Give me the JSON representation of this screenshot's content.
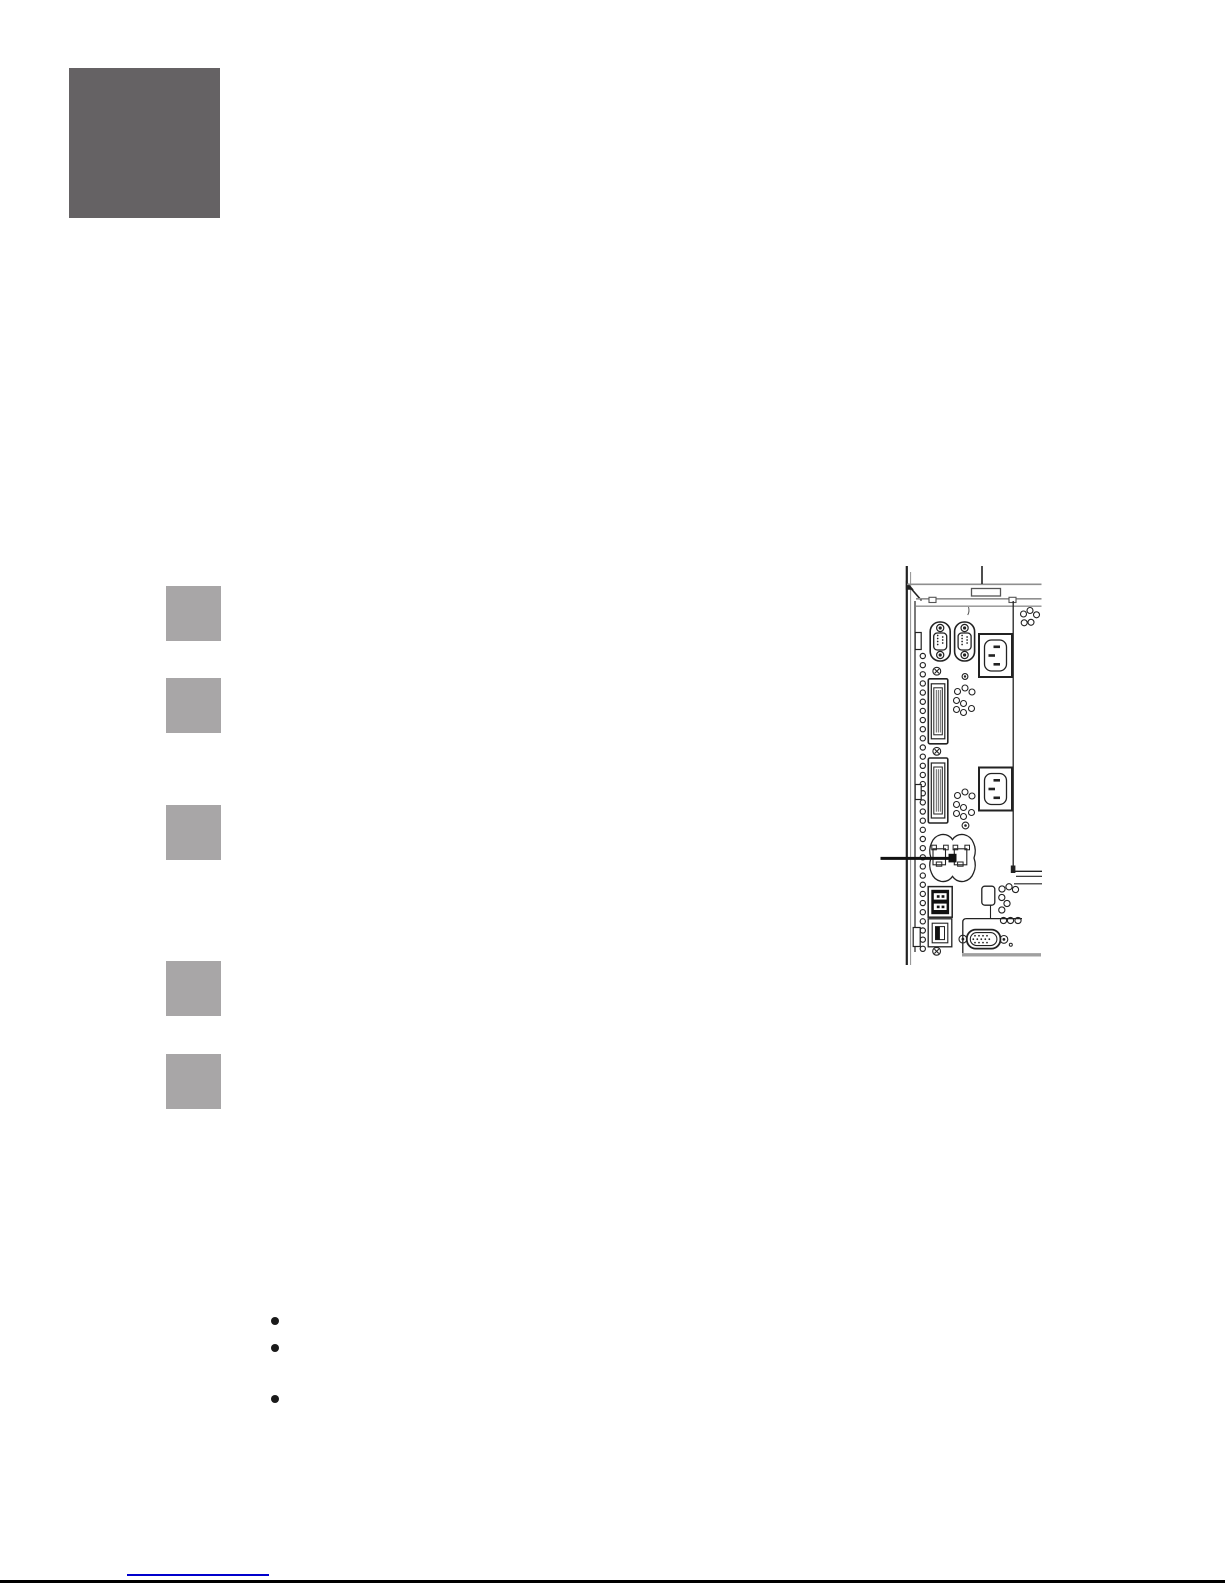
{
  "colors": {
    "page_bg": "#ffffff",
    "chapter_square": "#656264",
    "step_square": "#a8a6a7",
    "bullet": "#1a1a1a",
    "link_underline": "#0000cc",
    "footer_rule": "#000000",
    "fig_dark": "#222222",
    "fig_mid": "#555555",
    "fig_light": "#8f8f8f",
    "fig_shelf": "#a0a0a0"
  },
  "chapter_tab": {
    "label": ""
  },
  "step_markers": [
    {
      "label": ""
    },
    {
      "label": ""
    },
    {
      "label": ""
    },
    {
      "label": ""
    },
    {
      "label": ""
    }
  ],
  "bullets": [
    {
      "text": ""
    },
    {
      "text": ""
    },
    {
      "text": ""
    }
  ],
  "figure": {
    "caption": "",
    "icons": [
      "db9-serial-port-icon",
      "db9-serial-port-icon",
      "power-inlet-icon",
      "power-inlet-icon",
      "parallel-port-icon",
      "parallel-port-icon",
      "ethernet-ports-icon",
      "callout-line-icon",
      "usb-a-stack-icon",
      "usb-b-port-icon",
      "vga-port-icon",
      "vent-holes-icon",
      "screw-icon"
    ]
  },
  "footer": {
    "link_text": ""
  }
}
